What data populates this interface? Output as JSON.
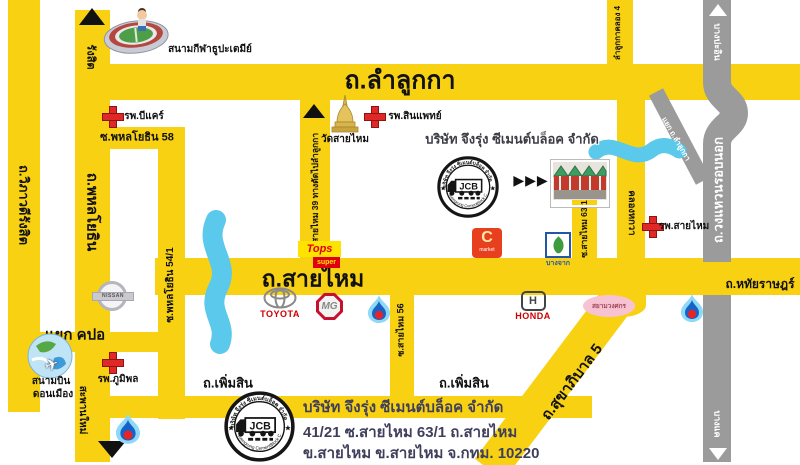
{
  "colors": {
    "road_yellow": "#F8D113",
    "ring_road_gray": "#9B9B9B",
    "canal_blue": "#5BC9EC",
    "hospital_red": "#E02826",
    "address_navy": "#3F3F5C"
  },
  "roads": {
    "lam_luk_ka": "ถ.ลำลูกกา",
    "sai_mai": "ถ.สายไหม",
    "vibhavadi_rangsit": "ถ.วิภาวดีรังสิต",
    "phahonyothin": "ถ.พหลโยธิน",
    "phahonyothin_58": "ซ.พหลโยธิน 58",
    "phahonyothin_54_1": "ซ.พหลโยธิน 54/1",
    "sai_mai_39": "ซ.สายไหม 39 ทางตัดไปลำลูกกา",
    "sai_mai_56": "ซ.สายไหม 56",
    "sai_mai_63_1": "ซ.สายไหม 63/1",
    "khlong_hok_wa": "คลองหกวา",
    "lam_luk_ka_khlong_4": "ลำลูกกาคลอง 4",
    "perm_sin": "ถ.เพิ่มสิน",
    "sukhaphiban_5": "ถ.สุขาภิบาล 5",
    "hathai_rat": "ถ.หทัยราษฎร์",
    "ring_road": "ถ.วงแหวนรอบนอก"
  },
  "directions": {
    "rangsit": "รังสิต",
    "saphan_mai": "สะพานใหม่",
    "bang_pa_in": "บางปะอิน",
    "bang_khae": "บางแค"
  },
  "junctions": {
    "kpo": "แยก คปอ",
    "lam_luk_ka_exit": "แยก ถ.ลำลูกกา"
  },
  "places": {
    "stadium": "สนามกีฬาธูปะเตมีย์",
    "temple": "วัดสายไหม",
    "hospital_bcare": "รพ.บีแคร์",
    "hospital_synphaet": "รพ.สินแพทย์",
    "hospital_sai_mai": "รพ.สายไหม",
    "hospital_bhumibol": "รพ.ภูมิพล",
    "airport_line1": "สนามบิน",
    "airport_line2": "ดอนเมือง",
    "siam_wongsakorn": "สยามวงศกร"
  },
  "company": {
    "name": "บริษัท จึงรุ่ง ซีเมนต์บล็อค จำกัด",
    "logo_text": "JCB",
    "logo_arc_top": "บริษัท จึงรุ่ง ซีเมนต์บล็อค จำกัด",
    "logo_arc_bottom": "Juengrung CementBlock Co.,Ltd.",
    "pointer_arrows": "▶▶▶",
    "address_line1": "บริษัท จึงรุ่ง ซีเมนต์บล็อค จำกัด",
    "address_line2": "41/21 ซ.สายไหม 63/1 ถ.สายไหม",
    "address_line3": "ข.สายไหม ข.สายไหม จ.กทม. 10220"
  },
  "brands": {
    "tops": "Tops",
    "tops_sub": "super",
    "toyota": "TOYOTA",
    "mg": "MG",
    "honda": "HONDA",
    "nissan": "NISSAN",
    "c_market": "C",
    "c_market_sub": "market",
    "bangchak": "บางจาก"
  }
}
